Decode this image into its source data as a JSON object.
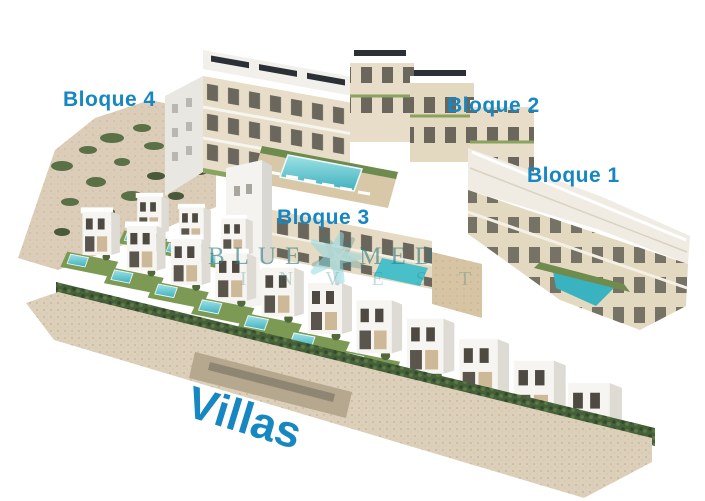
{
  "labels": {
    "bloque4": "Bloque 4",
    "bloque2": "Bloque 2",
    "bloque1": "Bloque 1",
    "bloque3": "Bloque 3",
    "villas": "Villas"
  },
  "watermark": {
    "word1": "BLUE",
    "word2": "MED",
    "line2": "INVEST",
    "logo": "starfish-icon"
  },
  "colors": {
    "label_blue": "#1787c1",
    "watermark_teal": "#2e7d80",
    "starfish_cyan": "#8ed9e2",
    "pool": "#4ec3cf",
    "pool_light": "#9fe2e6",
    "lawn": "#7d9a54",
    "hedge": "#46603a",
    "facade_cream": "#e7ddc8",
    "stone_wall": "#ddd0ba",
    "hillside": "#dccdb9"
  }
}
